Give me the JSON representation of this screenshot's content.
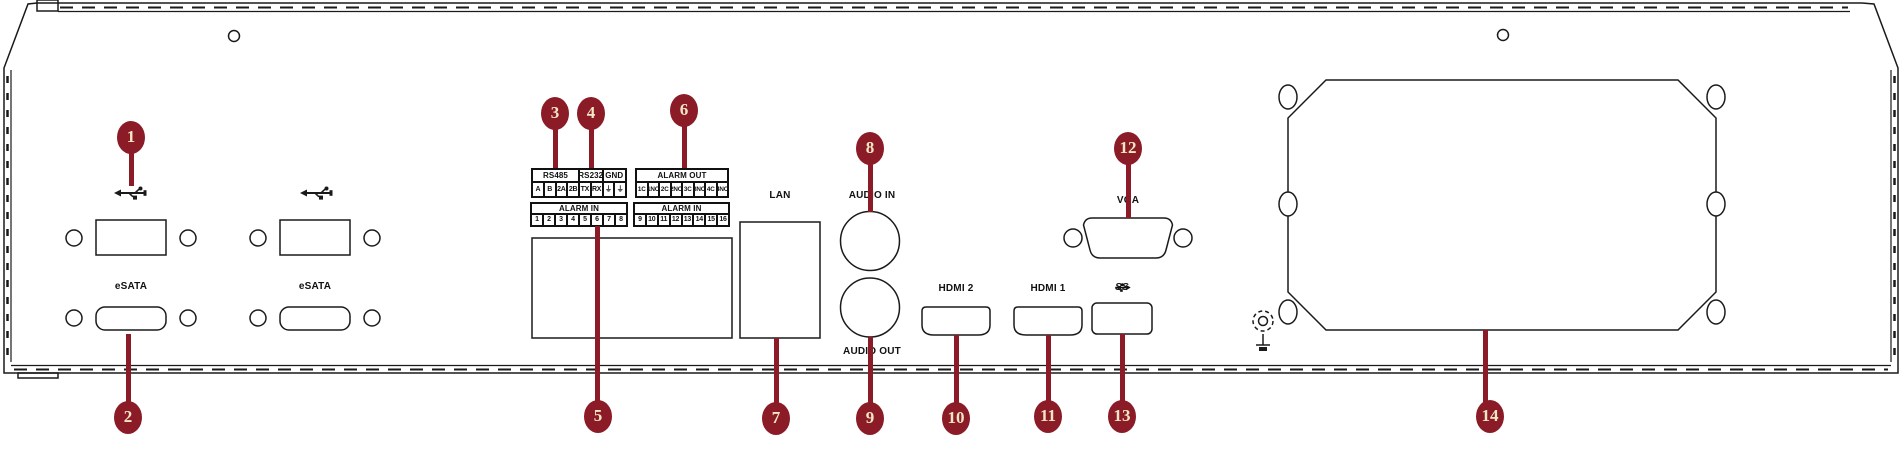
{
  "colors": {
    "callout": "#8B1B27",
    "ink": "#1a1a1a"
  },
  "labels": {
    "esata_1": "eSATA",
    "esata_2": "eSATA",
    "lan": "LAN",
    "audio_in": "AUDIO IN",
    "audio_out": "AUDIO OUT",
    "hdmi_2": "HDMI 2",
    "hdmi_1": "HDMI 1",
    "usb3_ss": "SS",
    "vga": "VGA"
  },
  "terminal_blocks": {
    "serial": {
      "headers": [
        {
          "label": "RS485",
          "span": 4
        },
        {
          "label": "RS232",
          "span": 2
        },
        {
          "label": "GND",
          "span": 2
        }
      ],
      "cells": [
        "A",
        "B",
        "2A",
        "2B",
        "TX",
        "RX",
        "⏚",
        "⏚"
      ]
    },
    "alarm_out": {
      "headers": [
        {
          "label": "ALARM OUT",
          "span": 8
        }
      ],
      "cells": [
        "1C",
        "1NO",
        "2C",
        "2NO",
        "3C",
        "3NO",
        "4C",
        "4NO"
      ]
    },
    "alarm_in_1": {
      "headers": [
        {
          "label": "ALARM IN",
          "span": 8
        }
      ],
      "cells": [
        "1",
        "2",
        "3",
        "4",
        "5",
        "6",
        "7",
        "8"
      ]
    },
    "alarm_in_2": {
      "headers": [
        {
          "label": "ALARM IN",
          "span": 8
        }
      ],
      "cells": [
        "9",
        "10",
        "11",
        "12",
        "13",
        "14",
        "15",
        "16"
      ]
    }
  },
  "callouts": [
    {
      "n": "1",
      "cx": 131,
      "cy": 137,
      "sx": 131,
      "sy1": 150,
      "sy2": 186
    },
    {
      "n": "2",
      "cx": 128,
      "cy": 417,
      "sx": 128,
      "sy1": 334,
      "sy2": 404
    },
    {
      "n": "3",
      "cx": 555,
      "cy": 113,
      "sx": 555,
      "sy1": 126,
      "sy2": 168
    },
    {
      "n": "4",
      "cx": 591,
      "cy": 113,
      "sx": 591,
      "sy1": 126,
      "sy2": 168
    },
    {
      "n": "5",
      "cx": 598,
      "cy": 416,
      "sx": 597,
      "sy1": 226,
      "sy2": 403
    },
    {
      "n": "6",
      "cx": 684,
      "cy": 110,
      "sx": 684,
      "sy1": 123,
      "sy2": 168
    },
    {
      "n": "7",
      "cx": 776,
      "cy": 418,
      "sx": 776,
      "sy1": 338,
      "sy2": 405
    },
    {
      "n": "8",
      "cx": 870,
      "cy": 148,
      "sx": 870,
      "sy1": 161,
      "sy2": 212
    },
    {
      "n": "9",
      "cx": 870,
      "cy": 418,
      "sx": 870,
      "sy1": 337,
      "sy2": 405
    },
    {
      "n": "10",
      "cx": 956,
      "cy": 418,
      "sx": 956,
      "sy1": 335,
      "sy2": 405
    },
    {
      "n": "11",
      "cx": 1048,
      "cy": 416,
      "sx": 1048,
      "sy1": 335,
      "sy2": 403
    },
    {
      "n": "12",
      "cx": 1128,
      "cy": 148,
      "sx": 1128,
      "sy1": 161,
      "sy2": 218
    },
    {
      "n": "13",
      "cx": 1122,
      "cy": 416,
      "sx": 1122,
      "sy1": 334,
      "sy2": 403
    },
    {
      "n": "14",
      "cx": 1490,
      "cy": 416,
      "sx": 1485,
      "sy1": 330,
      "sy2": 403
    }
  ]
}
